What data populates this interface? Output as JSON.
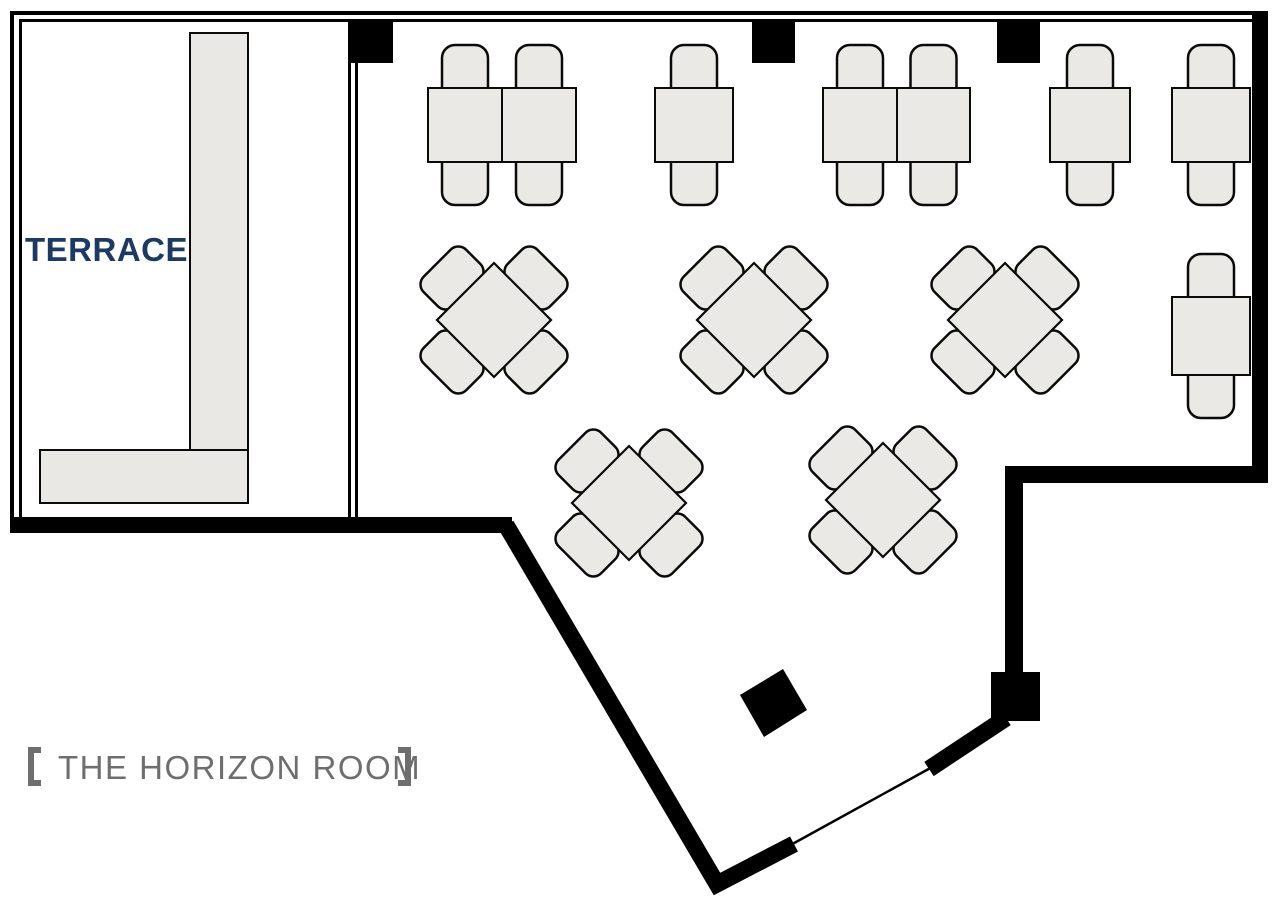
{
  "labels": {
    "terrace": {
      "text": "TERRACE",
      "color": "#1d3a63",
      "font_size": 33,
      "x": 25,
      "y": 261
    },
    "room": {
      "full": "【THE HORIZON ROOM】",
      "inner": "THE HORIZON ROOM",
      "color": "#6e6e6e",
      "font_size": 33,
      "x": 58,
      "y": 779
    }
  },
  "colors": {
    "background": "#ffffff",
    "wall": "#000000",
    "furniture_fill": "#eae9e6",
    "furniture_stroke": "#0a0a0a",
    "counter_fill": "#e9e8e5"
  },
  "floorplan": {
    "walls": {
      "rects": [
        {
          "name": "wall-top-outer",
          "x": 10,
          "y": 11,
          "w": 1258,
          "h": 4
        },
        {
          "name": "wall-top-inner",
          "x": 19,
          "y": 19,
          "w": 1233,
          "h": 3
        },
        {
          "name": "wall-left-outer",
          "x": 10,
          "y": 11,
          "w": 4,
          "h": 522
        },
        {
          "name": "wall-left-inner",
          "x": 19,
          "y": 19,
          "w": 3,
          "h": 498
        },
        {
          "name": "terrace-divider-a",
          "x": 348,
          "y": 22,
          "w": 3,
          "h": 495
        },
        {
          "name": "terrace-divider-b",
          "x": 355,
          "y": 22,
          "w": 3,
          "h": 495
        },
        {
          "name": "wall-terrace-bottom",
          "x": 10,
          "y": 517,
          "w": 502,
          "h": 16
        },
        {
          "name": "wall-right",
          "x": 1252,
          "y": 11,
          "w": 16,
          "h": 472
        },
        {
          "name": "wall-notch-horizontal",
          "x": 1005,
          "y": 466,
          "w": 263,
          "h": 17
        },
        {
          "name": "wall-notch-vertical",
          "x": 1005,
          "y": 466,
          "w": 18,
          "h": 207
        }
      ],
      "polylines": [
        {
          "name": "wall-diagonal-bottom",
          "points": "506,525 717,884 794,844",
          "width": 17
        }
      ],
      "lines": [
        {
          "name": "wall-door-jamb",
          "x1": 929,
          "y1": 769,
          "x2": 1006,
          "y2": 718,
          "width": 17
        },
        {
          "name": "door-line",
          "x1": 787,
          "y1": 847,
          "x2": 934,
          "y2": 766,
          "width": 2.5
        }
      ]
    },
    "pillars": {
      "rects": [
        {
          "name": "pillar-top-1",
          "x": 348,
          "y": 22,
          "w": 45,
          "h": 41
        },
        {
          "name": "pillar-top-2",
          "x": 752,
          "y": 22,
          "w": 43,
          "h": 41
        },
        {
          "name": "pillar-top-3",
          "x": 997,
          "y": 22,
          "w": 43,
          "h": 41
        },
        {
          "name": "pillar-door-corner",
          "x": 991,
          "y": 672,
          "w": 49,
          "h": 49
        }
      ],
      "polygons": [
        {
          "name": "pillar-diamond",
          "points": "783,669 807,710 764,737 740,695"
        }
      ]
    },
    "terrace_counter": [
      {
        "name": "terrace-counter-vertical",
        "x": 190,
        "y": 33,
        "w": 58,
        "h": 470
      },
      {
        "name": "terrace-counter-horizontal",
        "x": 40,
        "y": 450,
        "w": 208,
        "h": 53
      }
    ],
    "furniture": {
      "chair_style": {
        "w": 46,
        "h": 56,
        "rx": 13,
        "overhang": 43,
        "tuck": 13
      },
      "diamond_chair_style": {
        "w": 60,
        "h": 42,
        "rx": 11,
        "offset": 42
      },
      "diamond_half_diag": 57,
      "straight_tables": [
        {
          "x": 428,
          "y": 88,
          "w": 74,
          "h": 74
        },
        {
          "x": 502,
          "y": 88,
          "w": 74,
          "h": 74
        },
        {
          "x": 655,
          "y": 88,
          "w": 78,
          "h": 74
        },
        {
          "x": 823,
          "y": 88,
          "w": 74,
          "h": 74
        },
        {
          "x": 897,
          "y": 88,
          "w": 73,
          "h": 74
        },
        {
          "x": 1050,
          "y": 88,
          "w": 80,
          "h": 74
        },
        {
          "x": 1172,
          "y": 88,
          "w": 78,
          "h": 74
        },
        {
          "x": 1172,
          "y": 297,
          "w": 78,
          "h": 78
        }
      ],
      "diamond_tables": [
        {
          "cx": 494,
          "cy": 320
        },
        {
          "cx": 754,
          "cy": 320
        },
        {
          "cx": 1005,
          "cy": 320
        },
        {
          "cx": 629,
          "cy": 503
        },
        {
          "cx": 883,
          "cy": 500
        }
      ]
    }
  }
}
